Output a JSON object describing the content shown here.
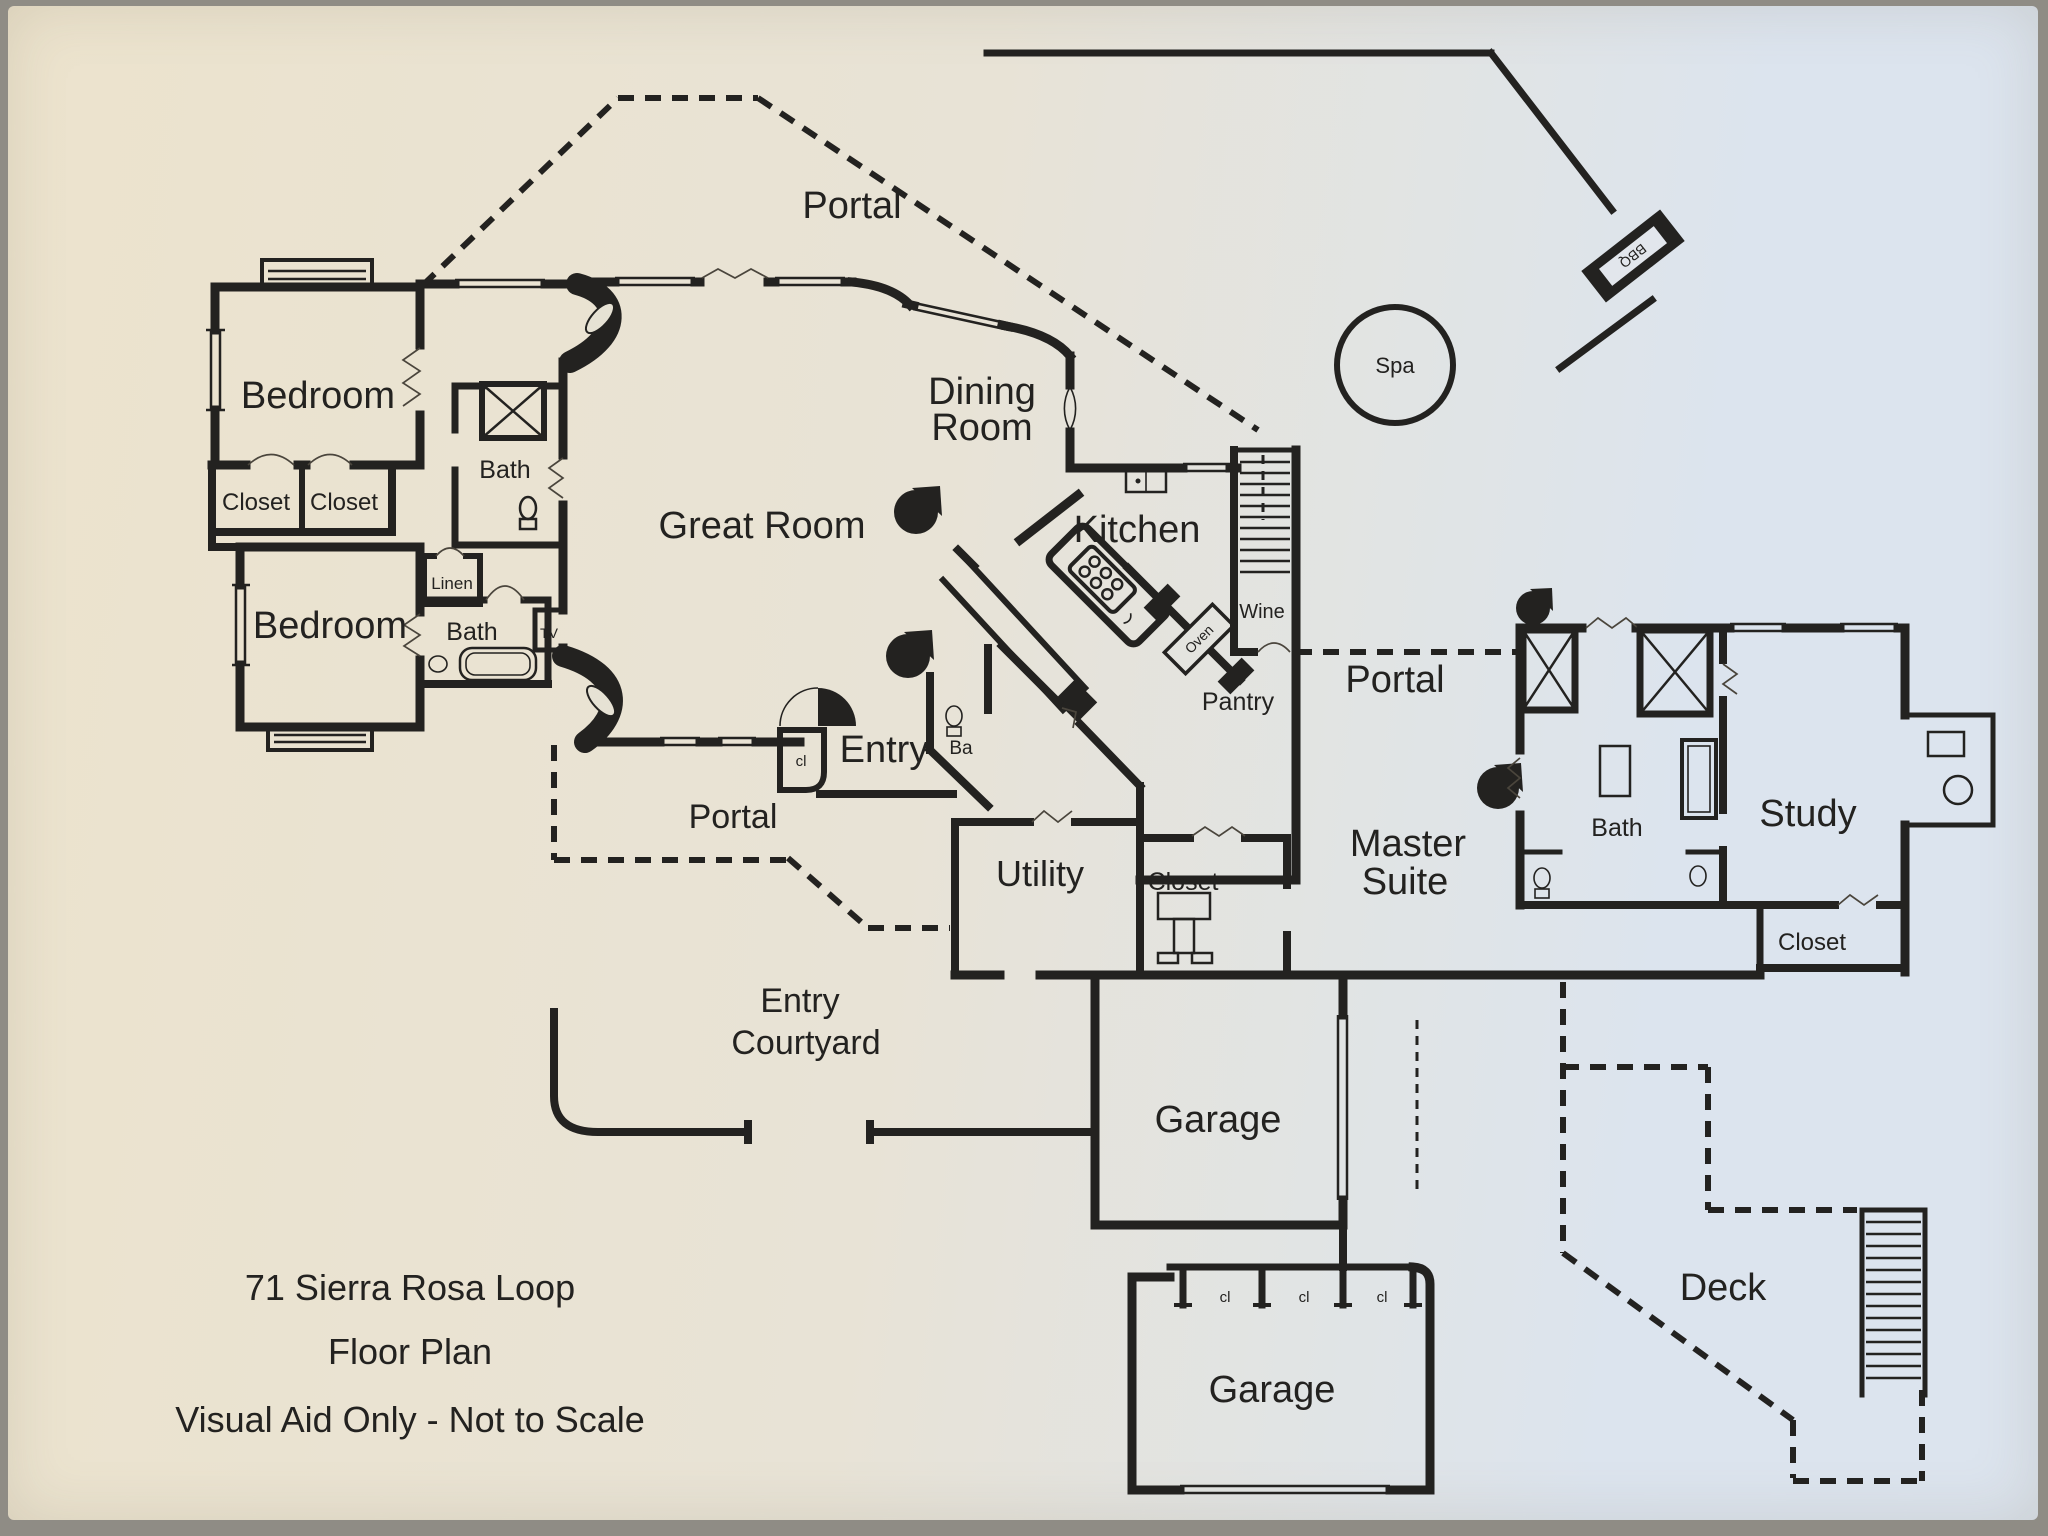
{
  "title": {
    "line1": "71 Sierra Rosa Loop",
    "line2": "Floor Plan",
    "line3": "Visual Aid Only - Not to Scale"
  },
  "labels": {
    "portal_top": "Portal",
    "portal_right": "Portal",
    "portal_left": "Portal",
    "bedroom_upper": "Bedroom",
    "bedroom_lower": "Bedroom",
    "bath_upper": "Bath",
    "bath_lower": "Bath",
    "bath_master": "Bath",
    "closet_upper_left": "Closet",
    "closet_upper_right": "Closet",
    "closet_master": "Closet",
    "closet_study": "Closet",
    "linen": "Linen",
    "tv": "TV",
    "great_room": "Great Room",
    "dining_line1": "Dining",
    "dining_line2": "Room",
    "kitchen": "Kitchen",
    "wine": "Wine",
    "oven": "Oven",
    "pantry": "Pantry",
    "spa": "Spa",
    "bbq": "BBQ",
    "entry": "Entry",
    "entry_cl": "cl",
    "ba": "Ba",
    "utility": "Utility",
    "master_line1": "Master",
    "master_line2": "Suite",
    "study": "Study",
    "courtyard_line1": "Entry",
    "courtyard_line2": "Courtyard",
    "garage_upper": "Garage",
    "garage_lower": "Garage",
    "garage_cl1": "cl",
    "garage_cl2": "cl",
    "garage_cl3": "cl",
    "deck": "Deck"
  },
  "colors": {
    "ink": "#232220",
    "paper_warm": "#ece3cd",
    "paper_mid": "#e8e3d6",
    "paper_cool": "#dce4ee",
    "photo_edge": "#8f8c85"
  }
}
